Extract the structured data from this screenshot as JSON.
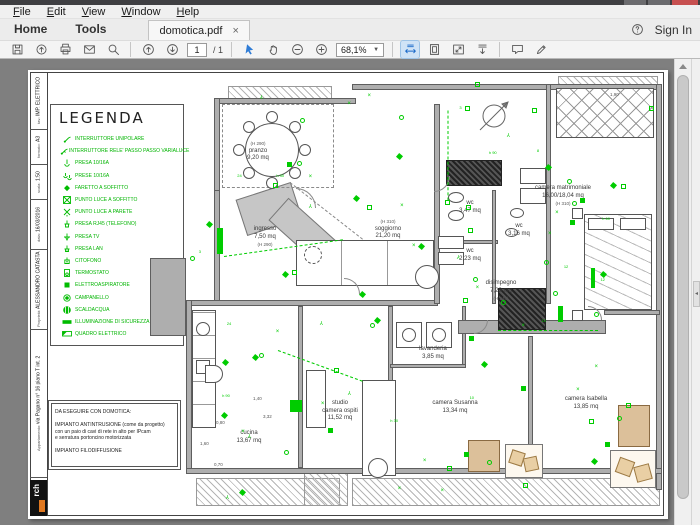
{
  "menubar": {
    "items": [
      "File",
      "Edit",
      "View",
      "Window",
      "Help"
    ]
  },
  "tabbar": {
    "home": "Home",
    "tools": "Tools",
    "document_tab": "domotica.pdf",
    "close_glyph": "×"
  },
  "toolbar": {
    "page_current": "1",
    "page_total": "/ 1",
    "zoom_value": "68,1%",
    "sign_in": "Sign In"
  },
  "colors": {
    "accent_blue": "#1b6ac9",
    "annotation_green": "#00c300",
    "wall_gray": "#aeaeae",
    "doc_bg": "#7f7f7f",
    "furniture_tan": "#dcc09a",
    "logo_accent": "#e07820"
  },
  "sheet": {
    "legend": {
      "title": "LEGENDA",
      "items": [
        {
          "symbol": "switch-icon",
          "label": "INTERRUTTORE UNIPOLARE"
        },
        {
          "symbol": "switch-dimmer-icon",
          "label": "INTERRUTTORE RELE' PASSO PASSO VARIALUCE"
        },
        {
          "symbol": "socket-icon",
          "label": "PRESA 10/16A"
        },
        {
          "symbol": "sockets-icon",
          "label": "PRESE 10/16A"
        },
        {
          "symbol": "spotlight-icon",
          "label": "FARETTO A SOFFITTO"
        },
        {
          "symbol": "ceiling-light-icon",
          "label": "PUNTO LUCE A SOFFITTO"
        },
        {
          "symbol": "wall-light-icon",
          "label": "PUNTO LUCE A PARETE"
        },
        {
          "symbol": "rj45-icon",
          "label": "PRESA RJ45 (TELEFONO)"
        },
        {
          "symbol": "tv-socket-icon",
          "label": "PRESA TV"
        },
        {
          "symbol": "lan-socket-icon",
          "label": "PRESA LAN"
        },
        {
          "symbol": "intercom-icon",
          "label": "CITOFONO"
        },
        {
          "symbol": "thermostat-icon",
          "label": "TERMOSTATO"
        },
        {
          "symbol": "extractor-icon",
          "label": "ELETTROASPIRATORE"
        },
        {
          "symbol": "doorbell-icon",
          "label": "CAMPANELLO"
        },
        {
          "symbol": "water-heater-icon",
          "label": "SCALDACQUA"
        },
        {
          "symbol": "safety-light-icon",
          "label": "ILLUMINAZIONE DI SICUREZZA"
        },
        {
          "symbol": "panel-icon",
          "label": "QUADRO ELETTRICO"
        }
      ]
    },
    "titleblock": {
      "fields": [
        {
          "label": "tav.:",
          "value": "IMP. ELETTRICO"
        },
        {
          "label": "formato:",
          "value": "A3"
        },
        {
          "label": "scala:",
          "value": "1:50"
        },
        {
          "label": "data:",
          "value": "16/03/2016"
        },
        {
          "label": "Proprietà:",
          "value": "ALESSANDRO CATASTA"
        },
        {
          "label": "Appartamento:",
          "value": "via Pagano n° 16 piano T int. 2"
        }
      ],
      "logo": "rch"
    },
    "note": {
      "lines": [
        "DA ESEGUIRE CON DOMOTICA:",
        "",
        "IMPIANTO ANTINTRUSIONE (come da progetto)",
        "con un paio di cavi di rete in alto per IPcam",
        "e serratura portoncino motorizzata",
        "",
        "IMPIANTO FILODIFFUSIONE"
      ]
    },
    "rooms": [
      {
        "name": "pranzo",
        "lines": [
          "(H 290)",
          "pranzo",
          "9,20 mq"
        ],
        "x": 230,
        "y": 70
      },
      {
        "name": "ingresso",
        "lines": [
          "ingresso",
          "7,50 mq",
          "(H 290)"
        ],
        "x": 237,
        "y": 156
      },
      {
        "name": "soggiorno",
        "lines": [
          "(H 310)",
          "soggiorno",
          "21,20 mq"
        ],
        "x": 360,
        "y": 148
      },
      {
        "name": "camera-matrimoniale",
        "lines": [
          "camera matrimoniale",
          "16,00/18,04 mq",
          "(H 310)"
        ],
        "x": 535,
        "y": 115
      },
      {
        "name": "wc-1",
        "lines": [
          "wc",
          "3,47 mq"
        ],
        "x": 442,
        "y": 130
      },
      {
        "name": "wc-2",
        "lines": [
          "wc",
          "3,16 mq"
        ],
        "x": 491,
        "y": 153
      },
      {
        "name": "wc-3",
        "lines": [
          "wc",
          "2,23 mq"
        ],
        "x": 442,
        "y": 178
      },
      {
        "name": "disimpegno",
        "lines": [
          "disimpegno",
          "7,23 mq",
          "(H 240)"
        ],
        "x": 473,
        "y": 210
      },
      {
        "name": "lavanderia",
        "lines": [
          "lavanderia",
          "3,85 mq"
        ],
        "x": 405,
        "y": 276
      },
      {
        "name": "studio-camera-ospiti",
        "lines": [
          "studio",
          "camera ospiti",
          "11,52 mq"
        ],
        "x": 312,
        "y": 330
      },
      {
        "name": "cucina",
        "lines": [
          "cucina",
          "13,67 mq"
        ],
        "x": 221,
        "y": 360
      },
      {
        "name": "camera-susanna",
        "lines": [
          "camera Susanna",
          "13,34 mq"
        ],
        "x": 427,
        "y": 330
      },
      {
        "name": "camera-isabella",
        "lines": [
          "camera Isabella",
          "13,85 mq"
        ],
        "x": 558,
        "y": 326
      }
    ],
    "dimensions": [
      {
        "t": "1,40",
        "x": 225,
        "y": 326
      },
      {
        "t": "3,32",
        "x": 235,
        "y": 344
      },
      {
        "t": "0,80",
        "x": 188,
        "y": 350
      },
      {
        "t": "1,60",
        "x": 172,
        "y": 371
      },
      {
        "t": "0,70",
        "x": 186,
        "y": 392
      },
      {
        "t": "1,90",
        "x": 582,
        "y": 22
      }
    ],
    "green_labels": [
      "24",
      "h 90",
      "10",
      "3",
      "12",
      "h 30",
      "8",
      "h 60"
    ]
  }
}
